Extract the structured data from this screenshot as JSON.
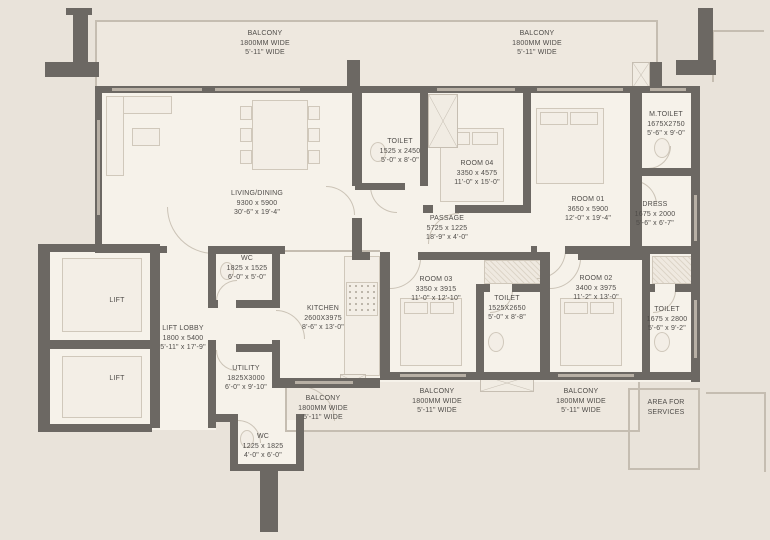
{
  "plan": {
    "type": "apartment-floor-plan",
    "colors": {
      "background": "#e9e3da",
      "room_fill": "#f6f2ea",
      "wall": "#6c6863",
      "window": "#b8b0a5",
      "text": "#4f4c49"
    },
    "labels": {
      "balcony_top_left": {
        "name": "BALCONY",
        "mm": "1800MM WIDE",
        "ft": "5'-11\" WIDE"
      },
      "balcony_top_right": {
        "name": "BALCONY",
        "mm": "1800MM WIDE",
        "ft": "5'-11\" WIDE"
      },
      "living_dining": {
        "name": "LIVING/DINING",
        "mm": "9300 x 5900",
        "ft": "30'-6\" x 19'-4\""
      },
      "toilet_room04": {
        "name": "TOILET",
        "mm": "1525 x 2450",
        "ft": "5'-0\" x 8'-0\""
      },
      "room04": {
        "name": "ROOM 04",
        "mm": "3350 x 4575",
        "ft": "11'-0\" x 15'-0\""
      },
      "m_toilet": {
        "name": "M.TOILET",
        "mm": "1675X2750",
        "ft": "5'-6\" x 9'-0\""
      },
      "room01": {
        "name": "ROOM 01",
        "mm": "3650 x 5900",
        "ft": "12'-0\" x 19'-4\""
      },
      "dress": {
        "name": "DRESS",
        "mm": "1675 x 2000",
        "ft": "5'-6\" x 6'-7\""
      },
      "passage": {
        "name": "PASSAGE",
        "mm": "5725 x 1225",
        "ft": "18'-9\" x 4'-0\""
      },
      "wc_mid": {
        "name": "WC",
        "mm": "1825 x 1525",
        "ft": "6'-0\" x 5'-0\""
      },
      "kitchen": {
        "name": "KITCHEN",
        "mm": "2600X3975",
        "ft": "8'-6\" x 13'-0\""
      },
      "room03": {
        "name": "ROOM 03",
        "mm": "3350 x 3915",
        "ft": "11'-0\" x 12'-10\""
      },
      "toilet_mid": {
        "name": "TOILET",
        "mm": "1525X2650",
        "ft": "5'-0\" x 8'-8\""
      },
      "room02": {
        "name": "ROOM 02",
        "mm": "3400 x 3975",
        "ft": "11'-2\" x 13'-0\""
      },
      "toilet_right": {
        "name": "TOILET",
        "mm": "1675 x 2800",
        "ft": "5'-6\" x 9'-2\""
      },
      "lift_top": {
        "name": "LIFT"
      },
      "lift_bottom": {
        "name": "LIFT"
      },
      "lift_lobby": {
        "name": "LIFT LOBBY",
        "mm": "1800 x 5400",
        "ft": "5'-11\" x 17'-9\""
      },
      "utility": {
        "name": "UTILITY",
        "mm": "1825X3000",
        "ft": "6'-0\" x 9'-10\""
      },
      "balcony_bottom_left": {
        "name": "BALCONY",
        "mm": "1800MM WIDE",
        "ft": "5'-11\" WIDE"
      },
      "balcony_bottom_mid": {
        "name": "BALCONY",
        "mm": "1800MM WIDE",
        "ft": "5'-11\" WIDE"
      },
      "balcony_bottom_right": {
        "name": "BALCONY",
        "mm": "1800MM WIDE",
        "ft": "5'-11\" WIDE"
      },
      "wc_bottom": {
        "name": "WC",
        "mm": "1225 x 1825",
        "ft": "4'-0\" x 6'-0\""
      },
      "area_services": {
        "line1": "AREA FOR",
        "line2": "SERVICES"
      }
    }
  }
}
